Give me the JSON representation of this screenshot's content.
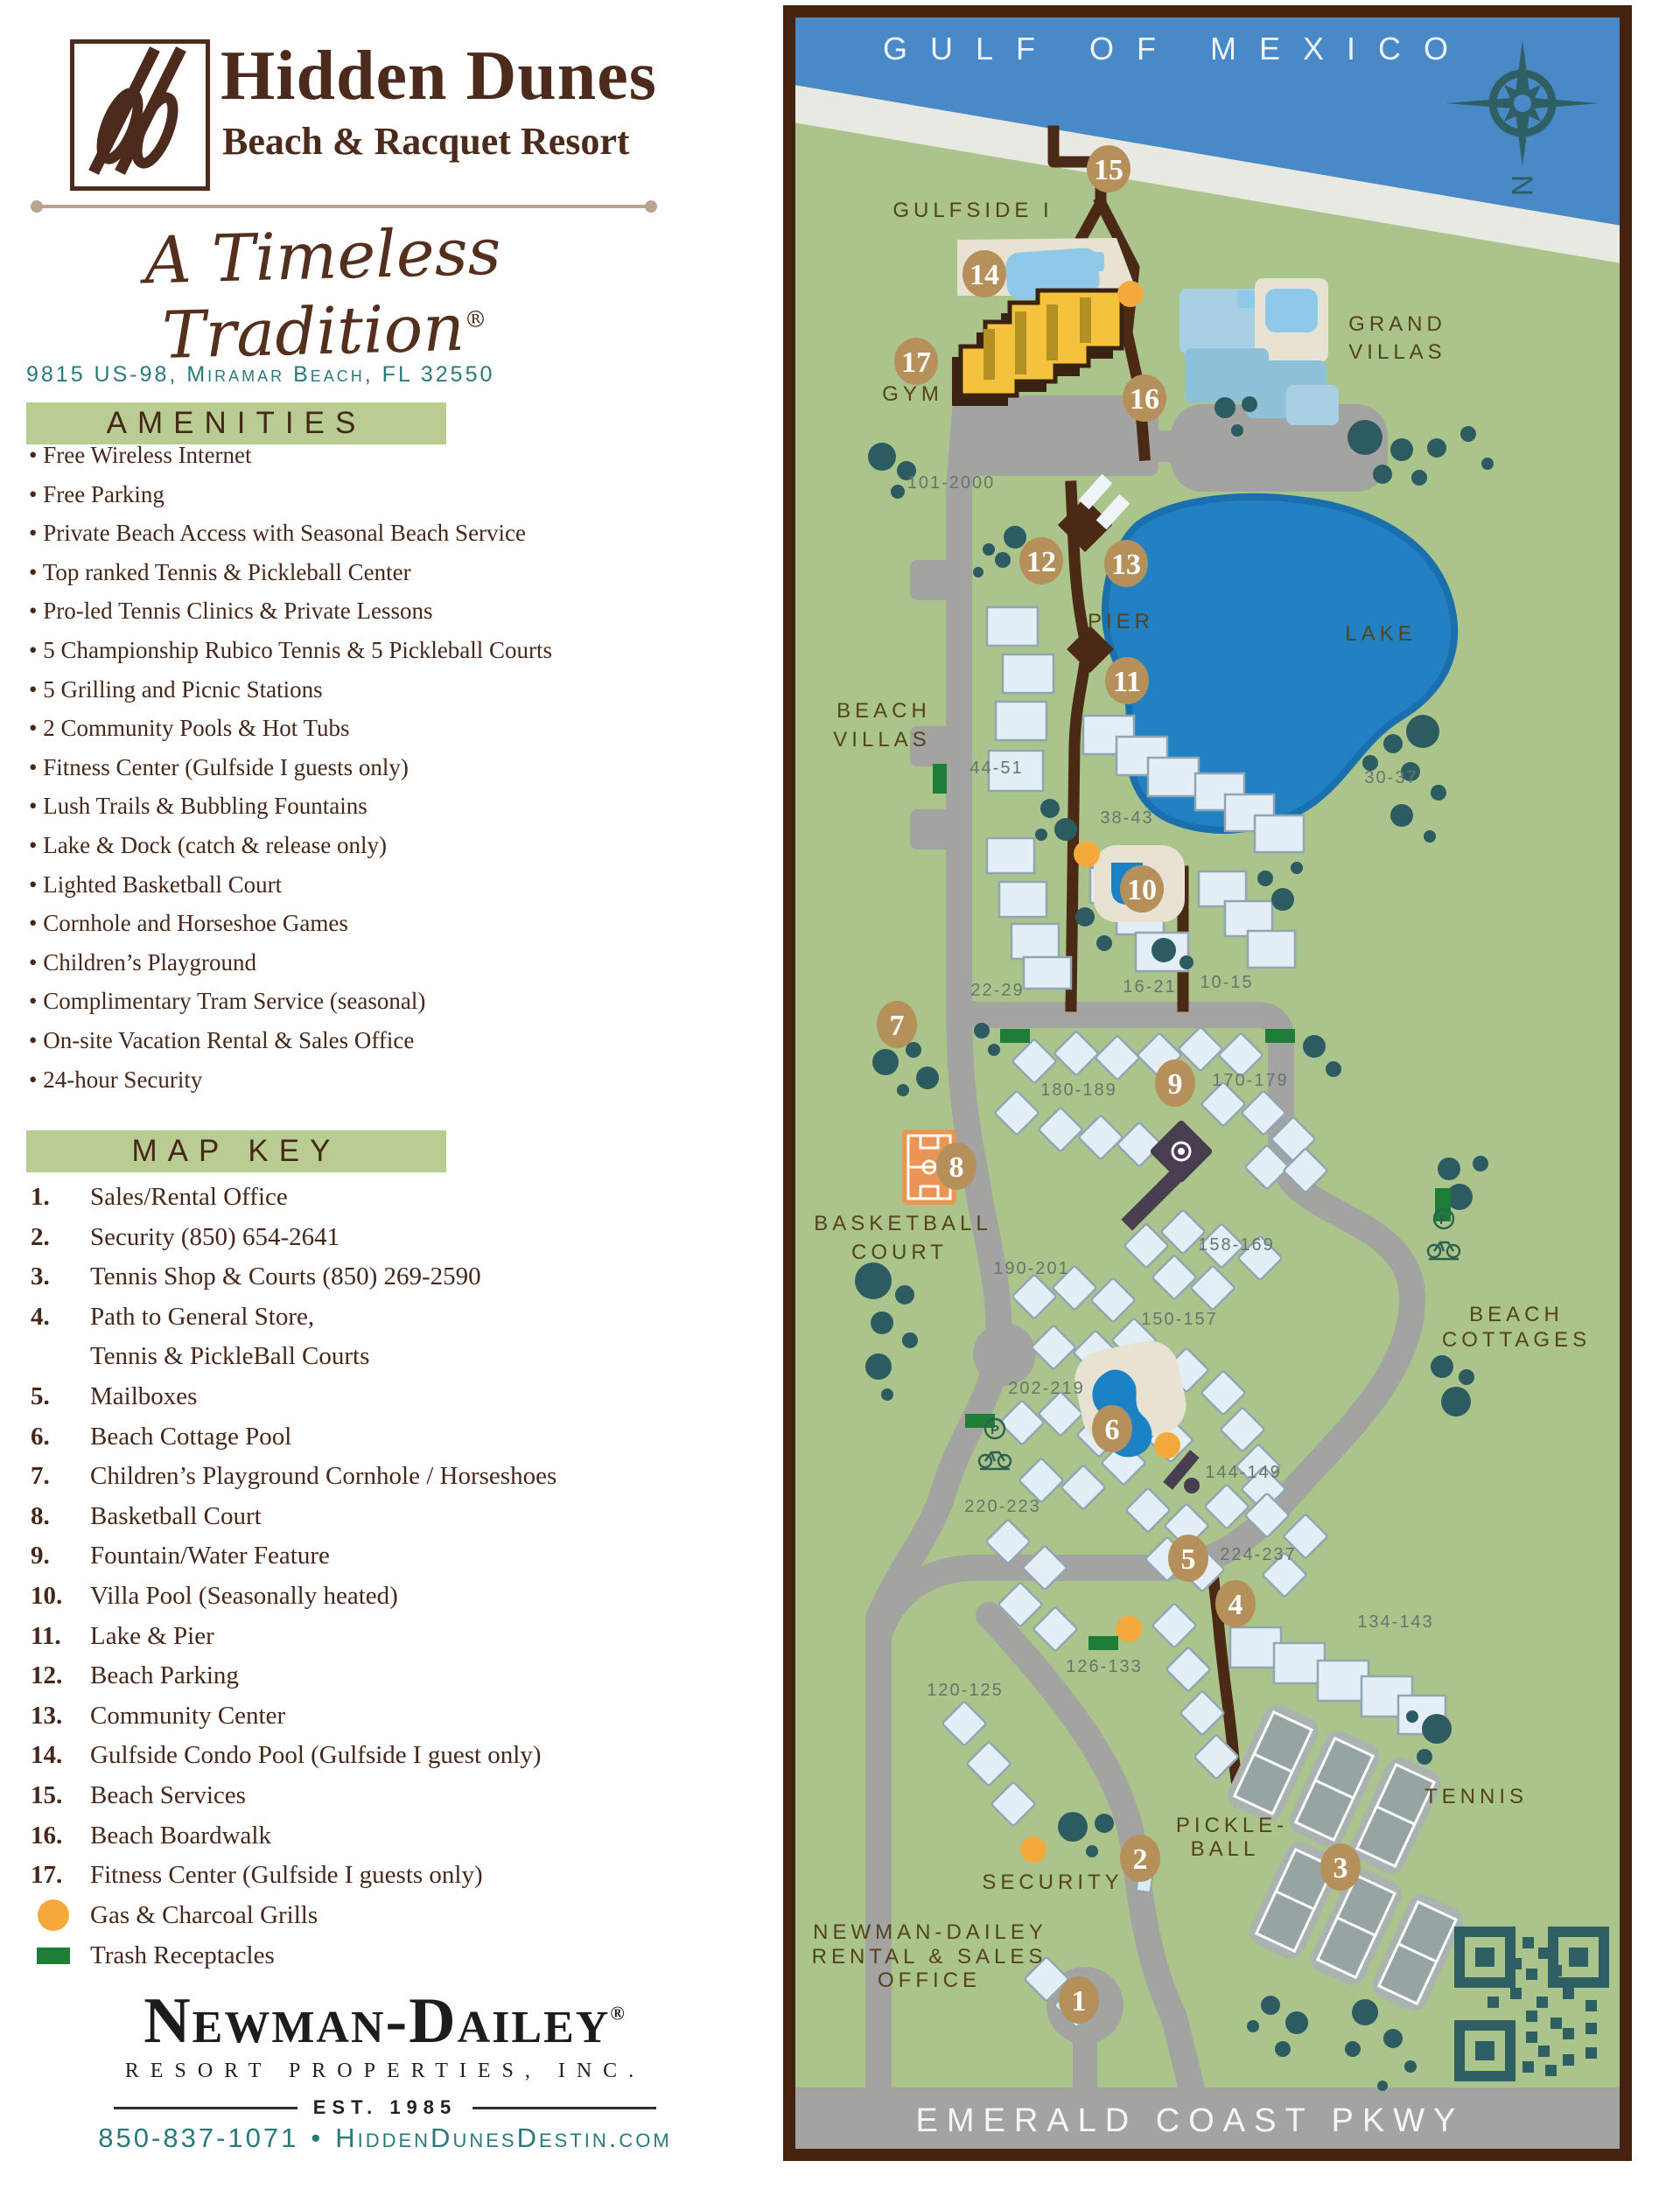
{
  "colors": {
    "brand_brown": "#4d2b1c",
    "text_brown": "#46281a",
    "banner_green": "#b9cd93",
    "teal": "#2a7a7c",
    "ink": "#1d1c1a",
    "map_border": "#45230f",
    "land": "#abc48c",
    "gulf": "#4a89c8",
    "sand": "#e9e9e4",
    "lake": "#2181c2",
    "lake_edge": "#1a6fae",
    "road": "#a3a3a1",
    "tree": "#2d5b62",
    "marker_tan": "#b6905a",
    "building": "#e3eef7",
    "building_edge": "#92a6b1",
    "villas_blue": "#a9cfe4",
    "villas_blue_dark": "#8fc0da",
    "deck": "#e7e2d2",
    "pool_light": "#8fc9e9",
    "pool_bright": "#1b82c5",
    "basketball": "#ea9554",
    "boardwalk": "#4b2a15",
    "grill_orange": "#f5a93b",
    "trash_green": "#1e7d37",
    "qr_teal": "#2e5f63",
    "label_olive": "#54431d",
    "label_gray": "#66766c",
    "map_white": "#eef4f9"
  },
  "brand": {
    "name": "Hidden Dunes",
    "subtitle": "Beach & Racquet Resort",
    "tagline": "A Timeless Tradition",
    "tagline_reg": "®",
    "address": "9815 US-98, Miramar Beach, FL 32550"
  },
  "amenities": {
    "title": "AMENITIES",
    "items": [
      "Free Wireless Internet",
      "Free Parking",
      "Private Beach Access with Seasonal Beach Service",
      "Top ranked Tennis & Pickleball Center",
      "Pro-led Tennis Clinics & Private Lessons",
      "5 Championship Rubico Tennis & 5 Pickleball Courts",
      "5 Grilling and Picnic Stations",
      "2 Community Pools & Hot Tubs",
      "Fitness Center (Gulfside I guests only)",
      "Lush Trails & Bubbling Fountains",
      "Lake & Dock (catch & release only)",
      "Lighted Basketball Court",
      "Cornhole and Horseshoe Games",
      "Children’s Playground",
      "Complimentary Tram Service (seasonal)",
      "On-site Vacation Rental & Sales Office",
      "24-hour Security"
    ]
  },
  "map_key": {
    "title": "MAP KEY",
    "items": [
      {
        "n": "1.",
        "label": "Sales/Rental Office"
      },
      {
        "n": "2.",
        "label": "Security (850) 654-2641"
      },
      {
        "n": "3.",
        "label": "Tennis Shop & Courts (850) 269-2590"
      },
      {
        "n": "4.",
        "label": "Path to General Store,",
        "label2": "Tennis & PickleBall Courts"
      },
      {
        "n": "5.",
        "label": "Mailboxes"
      },
      {
        "n": "6.",
        "label": "Beach Cottage Pool"
      },
      {
        "n": "7.",
        "label": "Children’s Playground Cornhole / Horseshoes"
      },
      {
        "n": "8.",
        "label": "Basketball Court"
      },
      {
        "n": "9.",
        "label": "Fountain/Water Feature"
      },
      {
        "n": "10.",
        "label": "Villa Pool (Seasonally heated)"
      },
      {
        "n": "11.",
        "label": "Lake & Pier"
      },
      {
        "n": "12.",
        "label": "Beach Parking"
      },
      {
        "n": "13.",
        "label": "Community Center"
      },
      {
        "n": "14.",
        "label": "Gulfside Condo Pool (Gulfside I guest only)"
      },
      {
        "n": "15.",
        "label": "Beach Services"
      },
      {
        "n": "16.",
        "label": "Beach Boardwalk"
      },
      {
        "n": "17.",
        "label": "Fitness Center (Gulfside I guests only)"
      }
    ],
    "legend": [
      {
        "icon": "grill-icon",
        "label": "Gas & Charcoal Grills"
      },
      {
        "icon": "trash-icon",
        "label": "Trash Receptacles"
      }
    ]
  },
  "footer": {
    "company": "Newman-Dailey",
    "company_reg": "®",
    "subtitle": "RESORT PROPERTIES, INC.",
    "est": "EST. 1985",
    "phone": "850-837-1071",
    "separator": "•",
    "website": "HiddenDunesDestin.com"
  },
  "map": {
    "compass_letter": "N",
    "parking_icon_letter": "P",
    "labels": [
      "GULF OF MEXICO",
      "GULFSIDE I",
      "GYM",
      "101-2000",
      "GRAND",
      "VILLAS",
      "PIER",
      "LAKE",
      "BEACH",
      "VILLAS",
      "44-51",
      "38-43",
      "30-37",
      "22-29",
      "16-21",
      "10-15",
      "180-189",
      "170-179",
      "BASKETBALL",
      "COURT",
      "190-201",
      "158-169",
      "150-157",
      "202-219",
      "144-149",
      "220-223",
      "224-237",
      "BEACH",
      "COTTAGES",
      "134-143",
      "126-133",
      "120-125",
      "PICKLE-",
      "BALL",
      "TENNIS",
      "SECURITY",
      "NEWMAN-DAILEY",
      "RENTAL & SALES",
      "OFFICE",
      "EMERALD COAST PKWY"
    ],
    "markers": [
      {
        "n": "1"
      },
      {
        "n": "2"
      },
      {
        "n": "3"
      },
      {
        "n": "4"
      },
      {
        "n": "5"
      },
      {
        "n": "6"
      },
      {
        "n": "7"
      },
      {
        "n": "8"
      },
      {
        "n": "9"
      },
      {
        "n": "10"
      },
      {
        "n": "11"
      },
      {
        "n": "12"
      },
      {
        "n": "13"
      },
      {
        "n": "14"
      },
      {
        "n": "15"
      },
      {
        "n": "16"
      },
      {
        "n": "17"
      }
    ]
  }
}
